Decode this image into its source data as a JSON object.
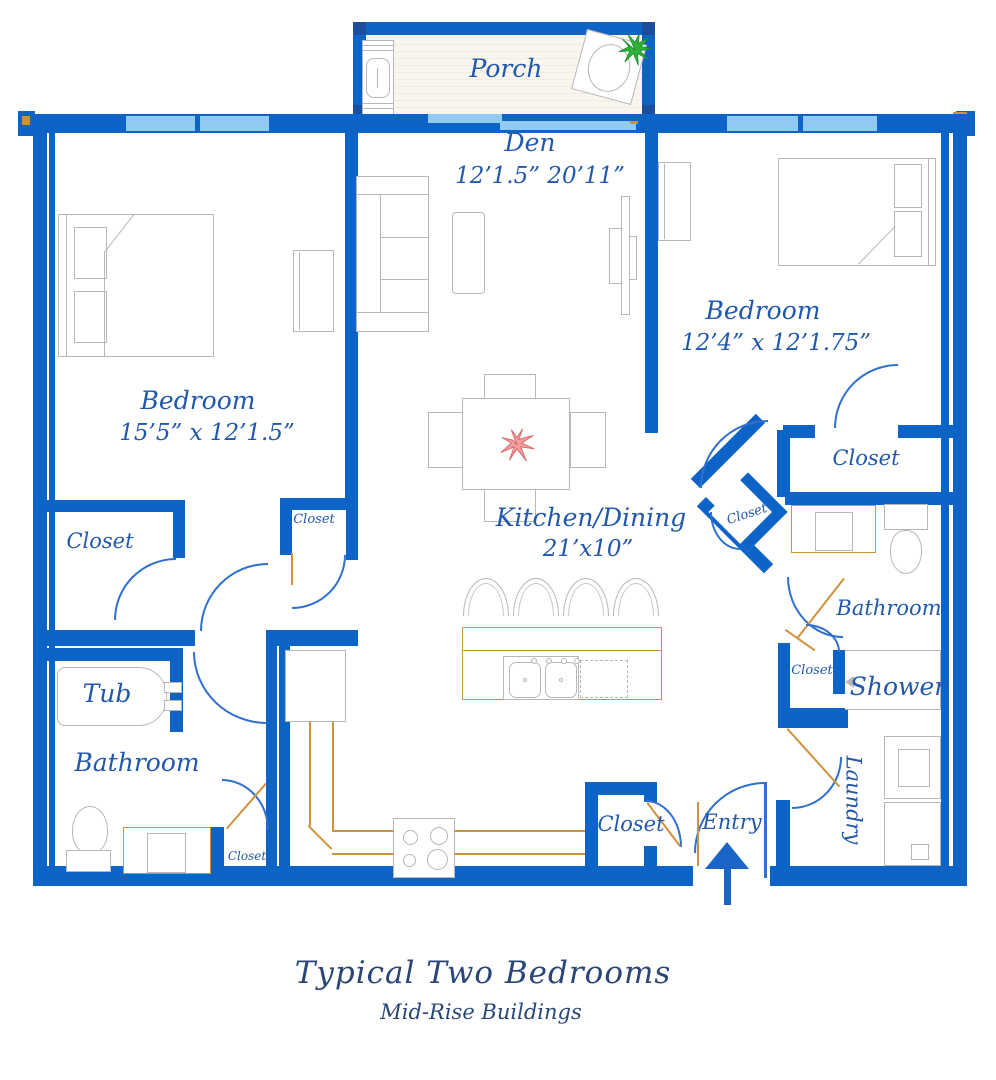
{
  "palette": {
    "wall_blue": "#0d63c6",
    "window_blue": "#92cbf2",
    "label_blue": "#2158ac",
    "title_navy": "#2a4677",
    "counter_orange": "#d0913d",
    "furniture_gray": "#b7b7b7",
    "door_arc_blue": "#2f6fd0",
    "flower_red": "#f09d9d",
    "plant_green": "#2fb13c"
  },
  "rooms": {
    "porch": {
      "label": "Porch"
    },
    "den": {
      "label": "Den",
      "dims": "12’1.5”  20’11”"
    },
    "bedroom_left": {
      "label": "Bedroom",
      "dims": "15’5” x 12’1.5”"
    },
    "bedroom_right": {
      "label": "Bedroom",
      "dims": "12’4” x 12’1.75”"
    },
    "kitchen_dining": {
      "label": "Kitchen/Dining",
      "dims": "21’x10”"
    },
    "bathroom_left": {
      "label": "Bathroom"
    },
    "bathroom_right": {
      "label": "Bathroom"
    },
    "tub": {
      "label": "Tub"
    },
    "shower": {
      "label": "Shower"
    },
    "laundry": {
      "label": "Laundry"
    },
    "entry": {
      "label": "Entry"
    },
    "closet_bedroom_left": {
      "label": "Closet"
    },
    "closet_hall_small": {
      "label": "Closet"
    },
    "closet_bedroom_right": {
      "label": "Closet"
    },
    "closet_hall_diamond": {
      "label": "Closet"
    },
    "closet_shower": {
      "label": "Closet"
    },
    "closet_bathroom_left": {
      "label": "Closet"
    },
    "closet_entry": {
      "label": "Closet"
    }
  },
  "footer": {
    "title": "Typical Two Bedrooms",
    "subtitle": "Mid-Rise Buildings"
  }
}
